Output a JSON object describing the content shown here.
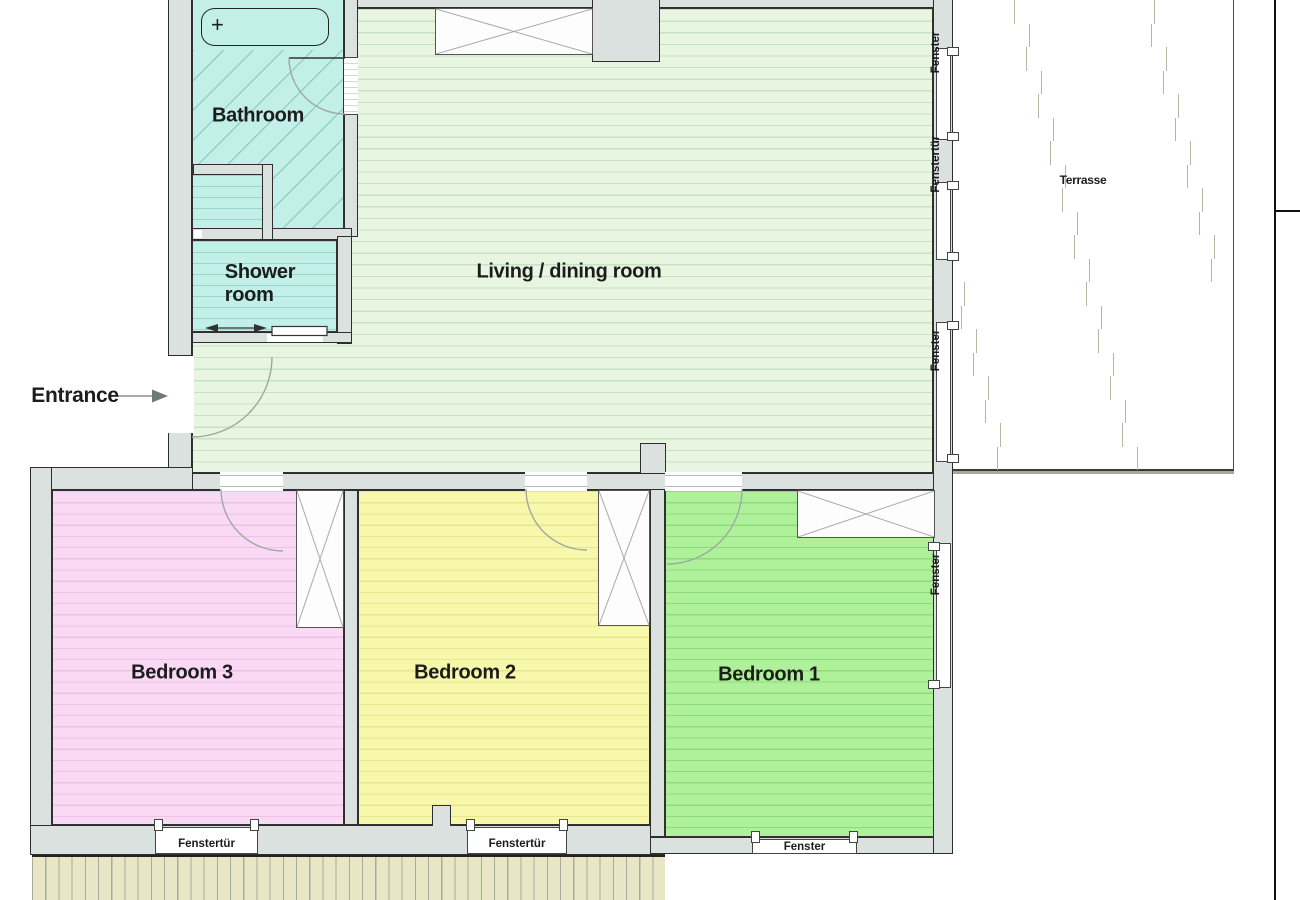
{
  "plan_title": "Apartment floor plan",
  "rooms": {
    "bathroom": {
      "name": "Bathroom",
      "color": "#c2f0e9"
    },
    "shower": {
      "name": "Shower\nroom",
      "color": "#c2f0e9"
    },
    "living": {
      "name": "Living / dining room",
      "color": "#e8f6e1"
    },
    "terrace": {
      "name": "Terrasse",
      "color": "#eae7c5"
    },
    "bedroom1": {
      "name": "Bedroom 1",
      "color": "#aff09a"
    },
    "bedroom2": {
      "name": "Bedroom 2",
      "color": "#f8f8ac"
    },
    "bedroom3": {
      "name": "Bedroom 3",
      "color": "#f9d9f4"
    }
  },
  "entrance": {
    "label": "Entrance"
  },
  "windows": {
    "right": [
      {
        "label": "Fenster"
      },
      {
        "label": "Fenstertür"
      },
      {
        "label": "Fenster"
      }
    ],
    "bedroom1_right": {
      "label": "Fenster"
    },
    "bottom": [
      {
        "label": "Fenstertür"
      },
      {
        "label": "Fenstertür"
      },
      {
        "label": "Fenster"
      }
    ]
  },
  "colors": {
    "wall": "#dbe1de",
    "outline": "#2e2e2e",
    "balcony": "#e9e6c6",
    "text": "#1c1c1c"
  }
}
